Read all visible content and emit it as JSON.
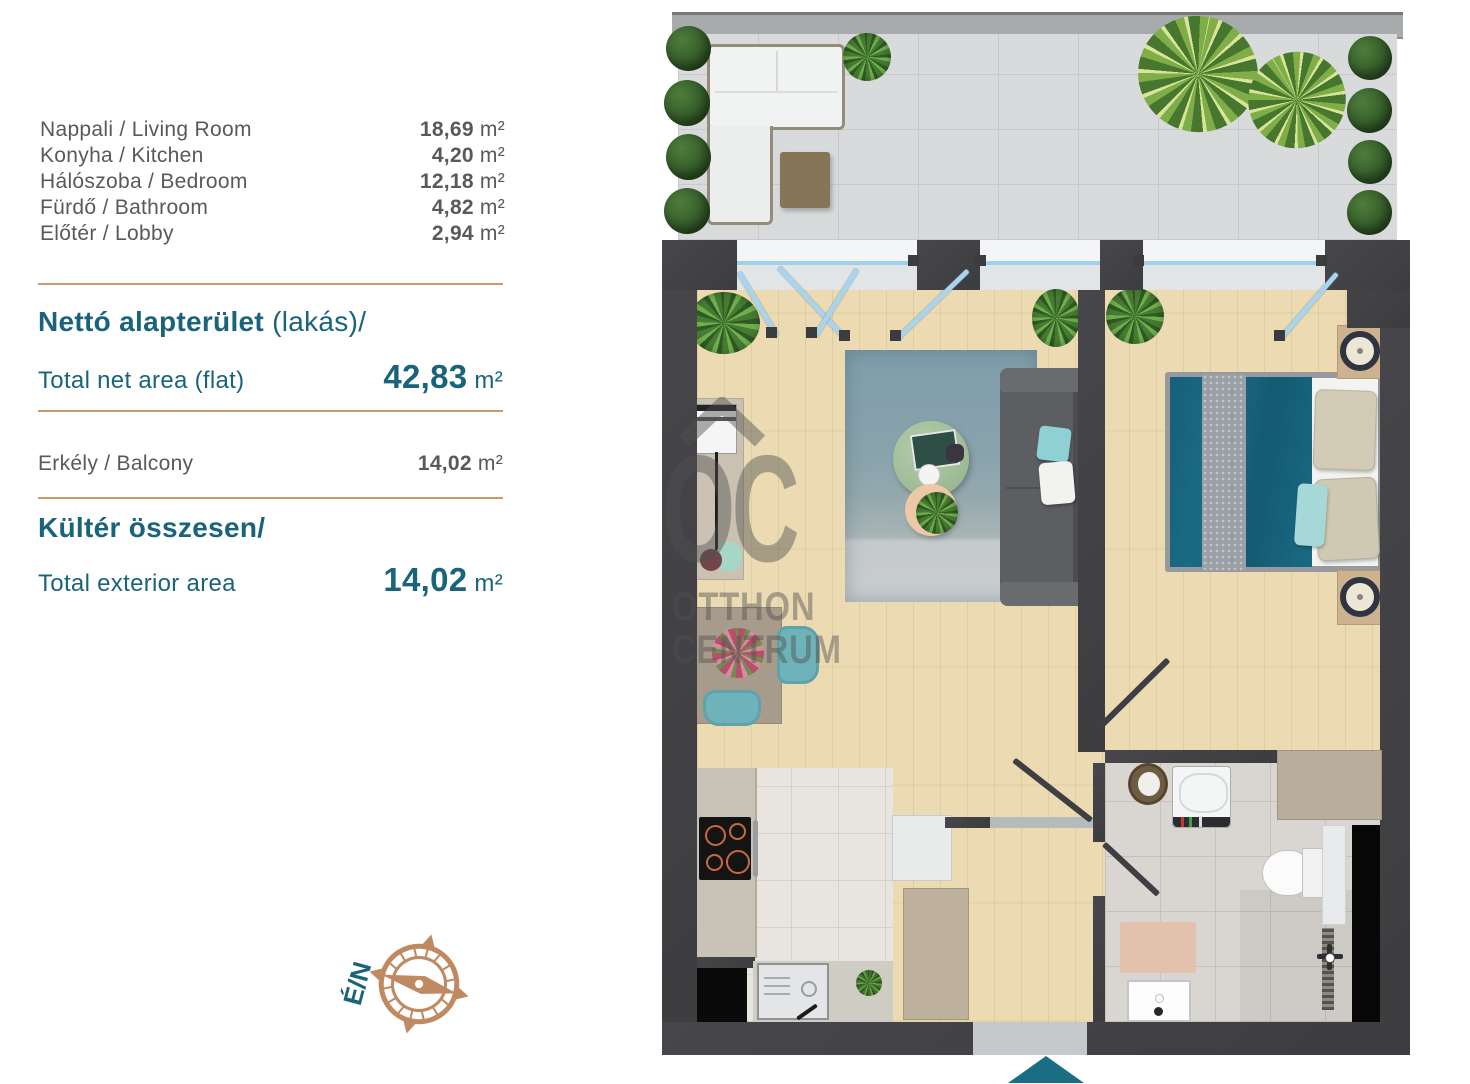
{
  "legend": {
    "rooms": [
      {
        "name": "Nappali / Living Room",
        "area": "18,69",
        "unit": "m²"
      },
      {
        "name": "Konyha / Kitchen",
        "area": "4,20",
        "unit": "m²"
      },
      {
        "name": "Hálószoba / Bedroom",
        "area": "12,18",
        "unit": "m²"
      },
      {
        "name": "Fürdő / Bathroom",
        "area": "4,82",
        "unit": "m²"
      },
      {
        "name": "Előtér / Lobby",
        "area": "2,94",
        "unit": "m²"
      }
    ],
    "net_title_main": "Nettó alapterület",
    "net_title_suffix": " (lakás)/",
    "net_subtitle": "Total net area (flat)",
    "net_value": "42,83",
    "net_unit": "m²",
    "balcony_name": "Erkély / Balcony",
    "balcony_area": "14,02",
    "balcony_unit": "m²",
    "exterior_title": "Kültér összesen/",
    "exterior_subtitle": "Total exterior area",
    "exterior_value": "14,02",
    "exterior_unit": "m²"
  },
  "compass": {
    "label": "É/N"
  },
  "watermark": {
    "monogram": "OC",
    "line1": "OTTHON",
    "line2": "CENTRUM"
  },
  "colors": {
    "accent_teal": "#19647a",
    "copper_divider": "#c89a6e",
    "compass_copper": "#bf8a62",
    "text_gray": "#59595b",
    "wall_dark": "#424245",
    "wood_floor": "#ecdbb2",
    "bed_teal": "#19637a",
    "entry_arrow": "#1a6e84"
  }
}
